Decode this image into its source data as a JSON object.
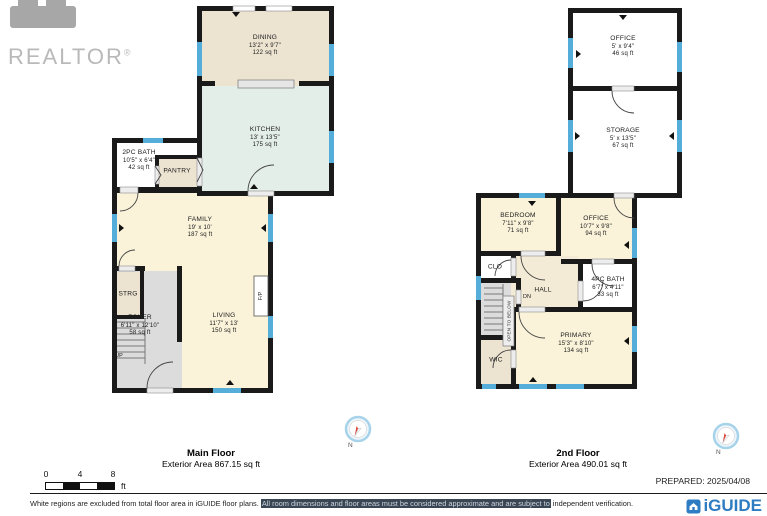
{
  "branding": {
    "realtor_label": "REALTOR",
    "realtor_reg": "®",
    "iguide_label": "iGUIDE",
    "prepared_label": "PREPARED: 2025/04/08"
  },
  "floors": {
    "main": {
      "title": "Main Floor",
      "subtitle": "Exterior Area 867.15 sq ft",
      "compass": "N",
      "rooms": {
        "dining": {
          "name": "DINING",
          "dims": "13'2\" x 9'7\"",
          "area": "122 sq ft"
        },
        "kitchen": {
          "name": "KITCHEN",
          "dims": "13' x 13'5\"",
          "area": "175 sq ft"
        },
        "bath2": {
          "name": "2PC BATH",
          "dims": "10'5\" x 6'4\"",
          "area": "42 sq ft"
        },
        "pantry": {
          "name": "PANTRY"
        },
        "family": {
          "name": "FAMILY",
          "dims": "19' x 10'",
          "area": "187 sq ft"
        },
        "strg": {
          "name": "STRG"
        },
        "foyer": {
          "name": "FOYER",
          "dims": "6'11\" x 12'10\"",
          "area": "58 sq ft"
        },
        "living": {
          "name": "LIVING",
          "dims": "11'7\" x 13'",
          "area": "150 sq ft"
        },
        "up": "UP",
        "fireplace": "F/P"
      }
    },
    "second": {
      "title": "2nd Floor",
      "subtitle": "Exterior Area 490.01 sq ft",
      "compass": "N",
      "rooms": {
        "office_upper": {
          "name": "OFFICE",
          "dims": "5' x 9'4\"",
          "area": "46 sq ft"
        },
        "storage": {
          "name": "STORAGE",
          "dims": "5' x 13'5\"",
          "area": "67 sq ft"
        },
        "bedroom": {
          "name": "BEDROOM",
          "dims": "7'11\" x 9'8\"",
          "area": "71 sq ft"
        },
        "office": {
          "name": "OFFICE",
          "dims": "10'7\" x 9'8\"",
          "area": "94 sq ft"
        },
        "clo": {
          "name": "CLO"
        },
        "hall": {
          "name": "HALL"
        },
        "bath4": {
          "name": "4PC BATH",
          "dims": "6'7\" x 4'11\"",
          "area": "33 sq ft"
        },
        "wic": {
          "name": "WIC"
        },
        "primary": {
          "name": "PRIMARY",
          "dims": "15'3\" x 8'10\"",
          "area": "134 sq ft"
        },
        "dn": "DN",
        "open_below": "OPEN TO BELOW"
      }
    }
  },
  "scale_bar": {
    "tick0": "0",
    "tick4": "4",
    "tick8": "8",
    "unit": "ft"
  },
  "footer": {
    "disclaimer_pre": "White regions are excluded from total floor area in iGUIDE floor plans. ",
    "disclaimer_highlight": "All room dimensions and floor areas must be considered approximate and are subject to",
    "disclaimer_post": " independent verification."
  },
  "colors": {
    "wall_black": "#1a1a1a",
    "window_blue": "#54aed9",
    "room_cream": "#faf3da",
    "room_beige": "#ece3d1",
    "room_mint": "#e4eee9",
    "room_gray": "#dcdcdc",
    "highlight_bg": "#3a4654",
    "iguide_blue": "#2e7cc1"
  }
}
